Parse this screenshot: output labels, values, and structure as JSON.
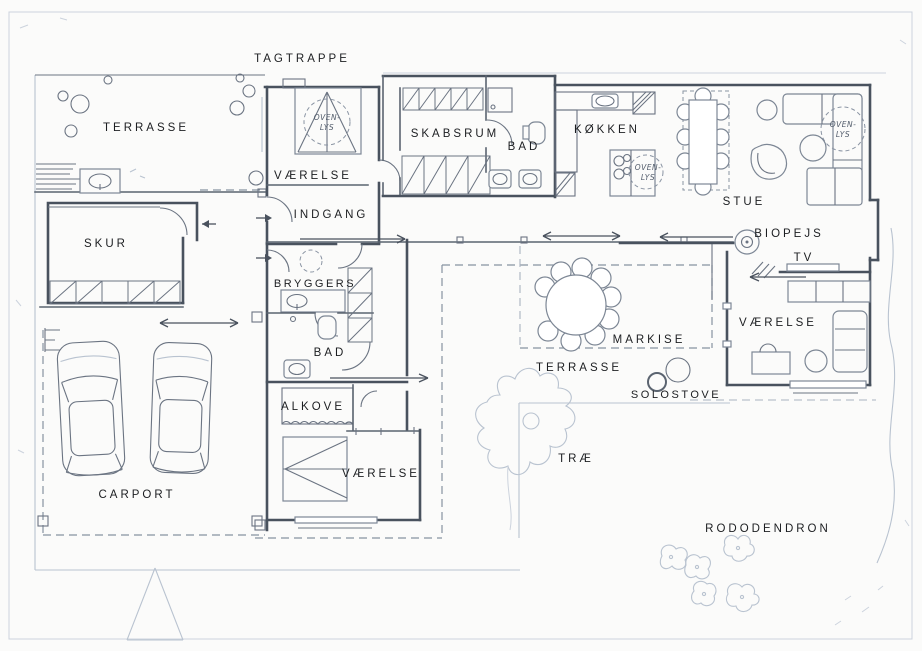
{
  "drawing_title": "house floor plan sketch",
  "colors": {
    "paper": "#fbfbfa",
    "ink": "#49525e",
    "pencil_light": "#b9c3d0"
  },
  "labels": {
    "tagtrappe": "TAGTRAPPE",
    "terrasse_nw": "TERRASSE",
    "vaerelse_top": "VÆRELSE",
    "indgang": "INDGANG",
    "skabsrum": "SKABSRUM",
    "bad_top": "BAD",
    "koekken": "KØKKEN",
    "stue": "STUE",
    "biopejs": "BIOPEJS",
    "tv": "TV",
    "skur": "SKUR",
    "bryggers": "BRYGGERS",
    "bad_mid": "BAD",
    "alkove": "ALKOVE",
    "vaerelse_right": "VÆRELSE",
    "markise": "MARKISE",
    "terrasse_court": "TERRASSE",
    "solostove": "SOLOSTOVE",
    "vaerelse_bottom": "VÆRELSE",
    "carport": "CARPORT",
    "trae": "TRÆ",
    "rododendron": "RODODENDRON",
    "ovenlys": {
      "line1": "OVEN-",
      "line2": "LYS"
    }
  }
}
